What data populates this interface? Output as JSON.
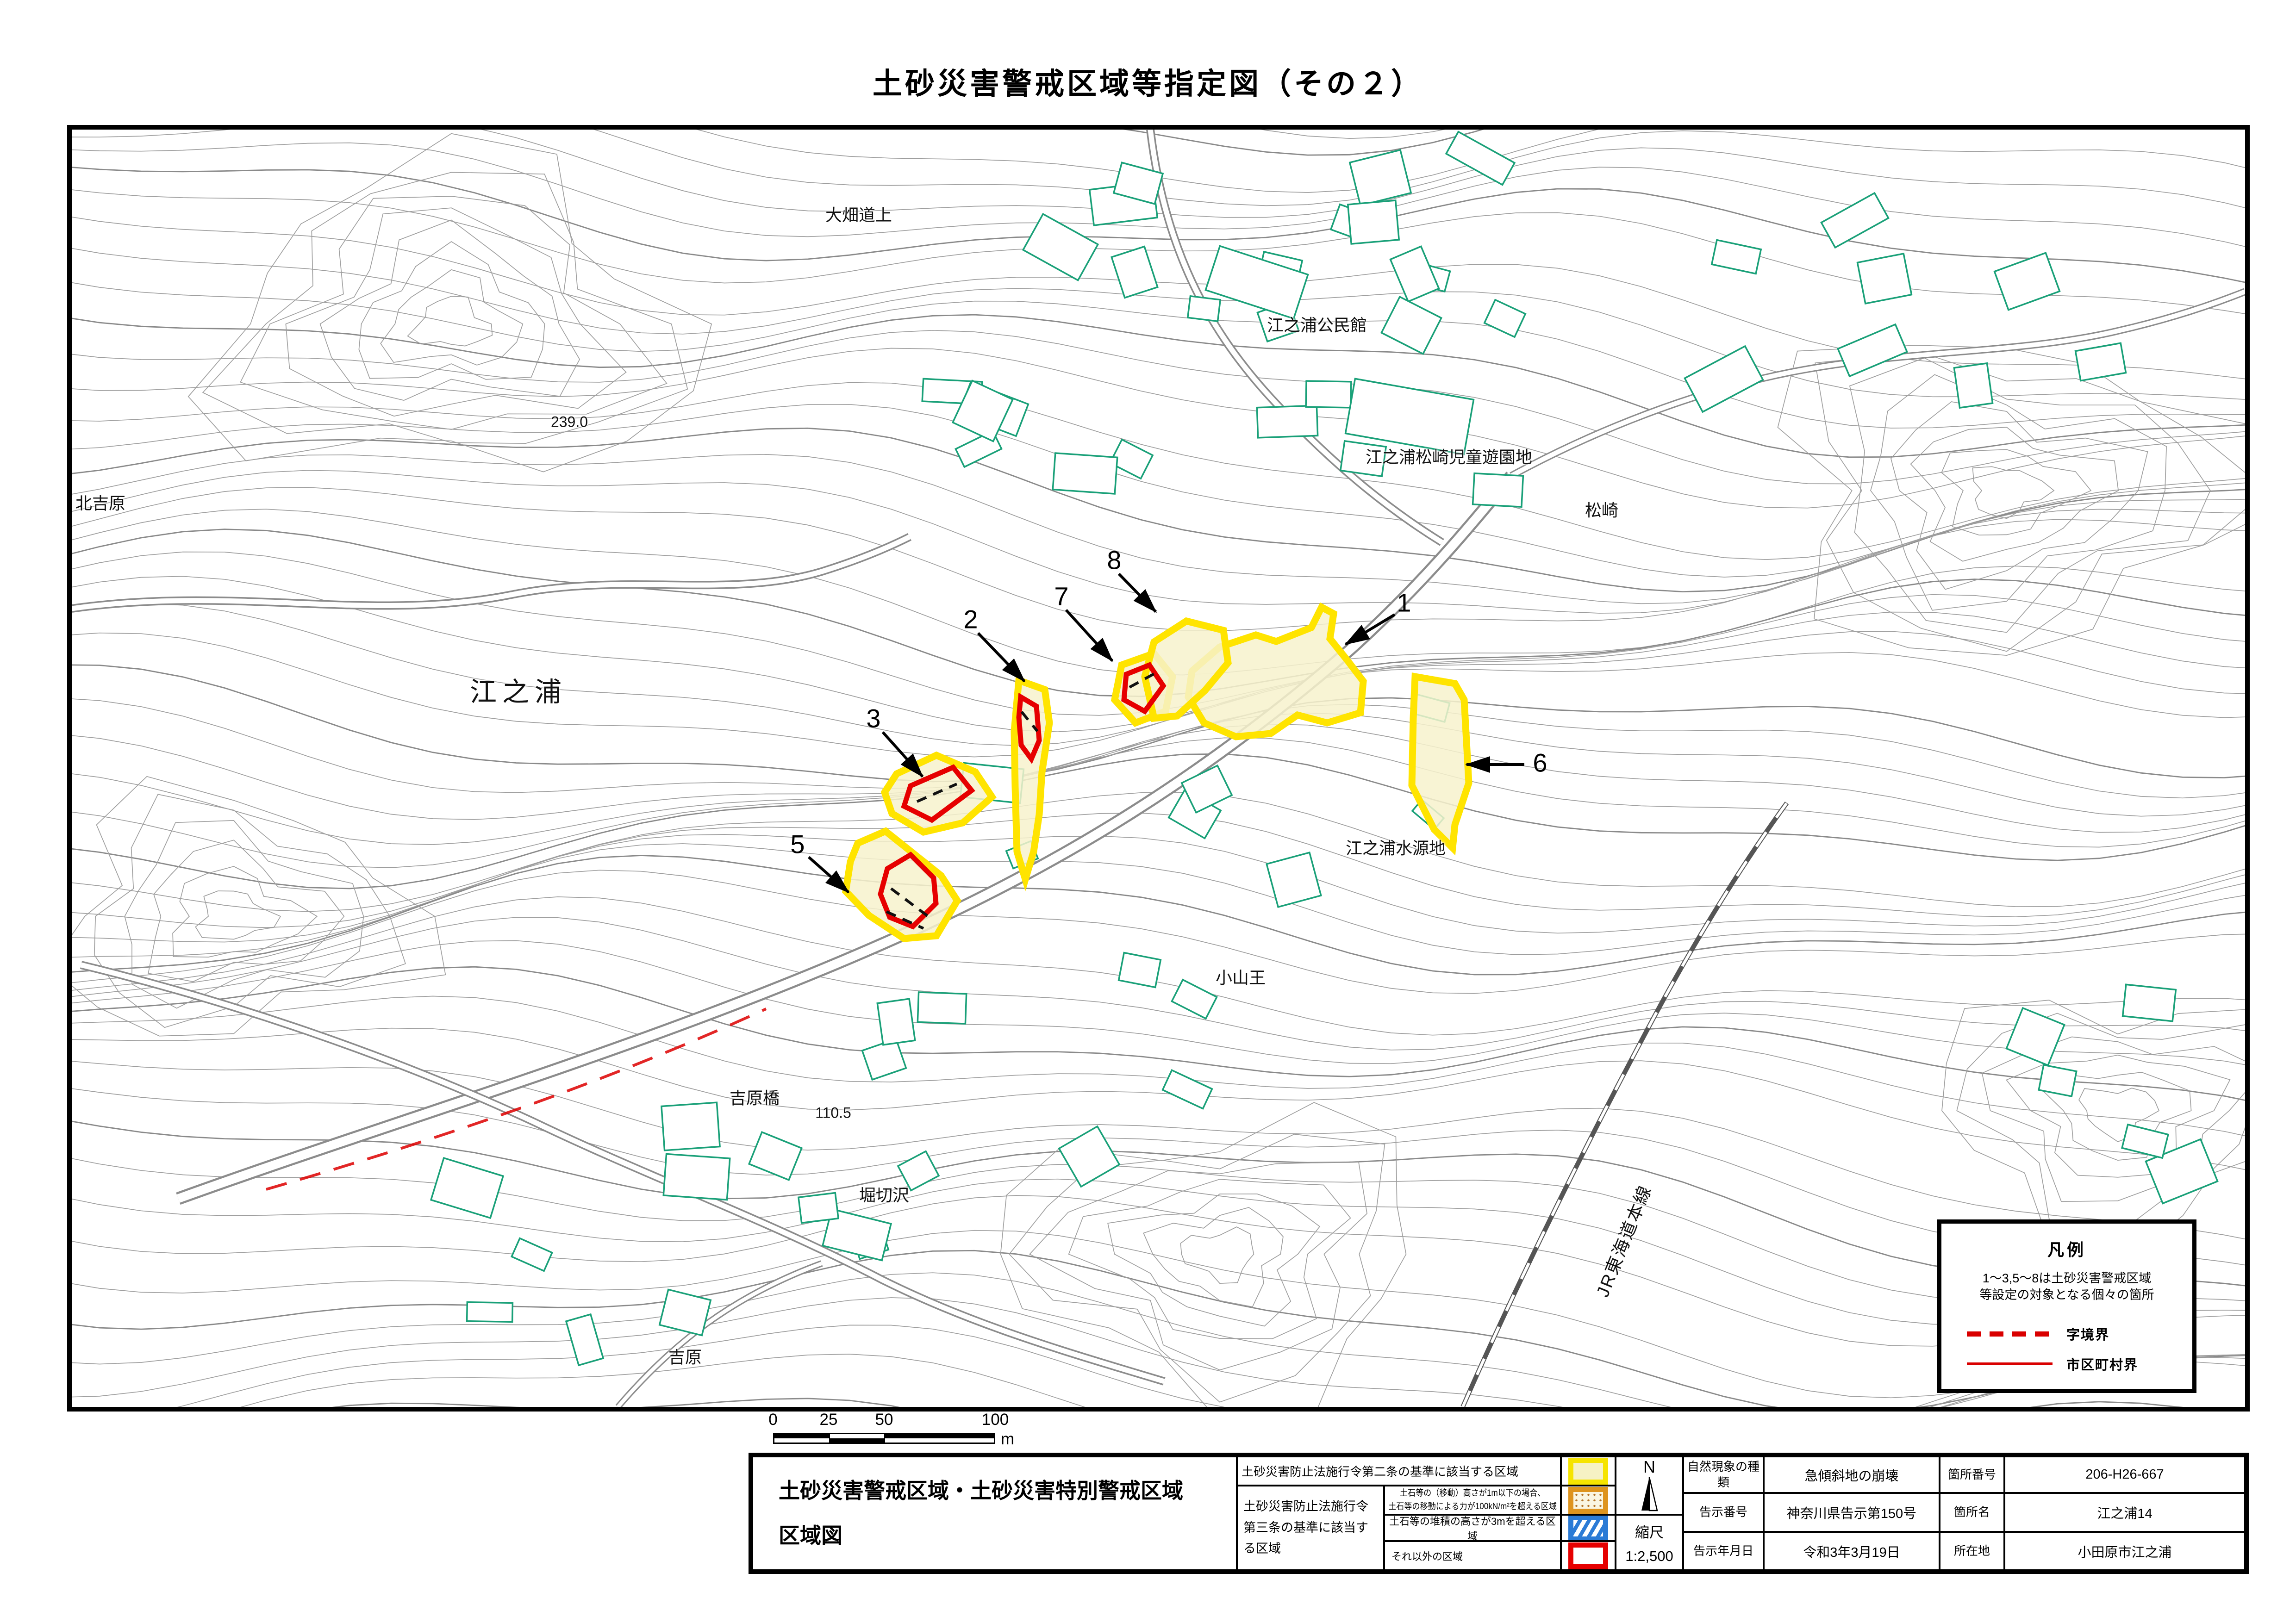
{
  "title": "土砂災害警戒区域等指定図（その２）",
  "map": {
    "labels": {
      "obata": "大畑道上",
      "kouminkan": "江之浦公民館",
      "jidouyuuenchi": "江之浦松崎児童遊園地",
      "matsuzaki": "松崎",
      "elev239": "239.0",
      "kitayoshiwara": "北吉原",
      "enoura": "江之浦",
      "suigenchi": "江之浦水源地",
      "koyamaou": "小山王",
      "yoshiwarabashi": "吉原橋",
      "elev110": "110.5",
      "horikirisawa": "堀切沢",
      "yoshiwara": "吉原",
      "jr": "JR東海道本線"
    },
    "zone_numbers": {
      "z1": "1",
      "z2": "2",
      "z3": "3",
      "z5": "5",
      "z6": "6",
      "z7": "7",
      "z8": "8"
    }
  },
  "legend_box": {
    "title": "凡例",
    "note_line1": "1～3,5～8は土砂災害警戒区域",
    "note_line2": "等設定の対象となる個々の箇所",
    "dashed_label": "字境界",
    "solid_label": "市区町村界"
  },
  "scale_bar": {
    "t0": "0",
    "t25": "25",
    "t50": "50",
    "t100": "100",
    "unit": "m"
  },
  "table": {
    "sheet_title_line1": "土砂災害警戒区域・土砂災害特別警戒区域",
    "sheet_title_line2": "区域図",
    "law2_label": "土砂災害防止法施行令第二条の基準に該当する区域",
    "law3_label": "土砂災害防止法施行令第三条の基準に該当する区域",
    "row2_line1": "土石等の（移動）高さが1m以下の場合、",
    "row2_line2": "土石等の移動による力が100kN/m²を超える区域",
    "row3_desc": "土石等の堆積の高さが3mを超える区域",
    "row4_desc": "それ以外の区域",
    "compass": "N",
    "scale_label": "縮尺",
    "scale_value": "1:2,500",
    "info": {
      "rows": [
        {
          "k1": "自然現象の種類",
          "v1": "急傾斜地の崩壊",
          "k2": "箇所番号",
          "v2": "206-H26-667"
        },
        {
          "k1": "告示番号",
          "v1": "神奈川県告示第150号",
          "k2": "箇所名",
          "v2": "江之浦14"
        },
        {
          "k1": "告示年月日",
          "v1": "令和3年3月19日",
          "k2": "所在地",
          "v2": "小田原市江之浦"
        }
      ]
    }
  },
  "colors": {
    "warning_yellow": "#ffe400",
    "special_red": "#e60000",
    "contour_gray": "#9b9b9b",
    "building_teal": "#19a078",
    "boundary_red": "#dd0000"
  }
}
